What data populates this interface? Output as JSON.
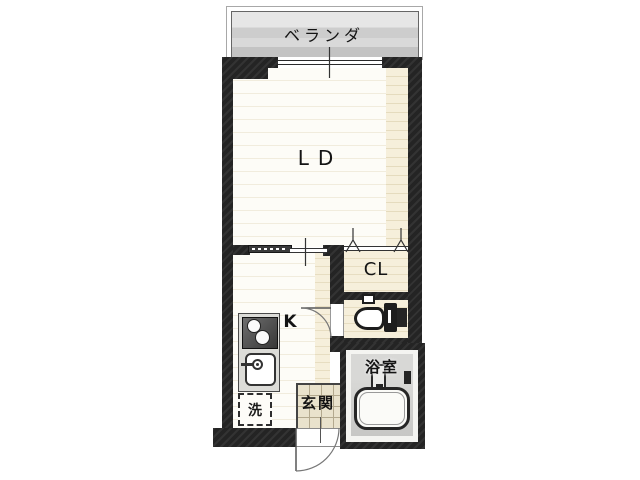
{
  "balcony": {
    "label": "ベランダ"
  },
  "rooms": {
    "living_dining": {
      "label": "LD"
    },
    "closet": {
      "label": "CL"
    },
    "kitchen": {
      "label": "K"
    },
    "bathroom": {
      "label": "浴室"
    },
    "entrance": {
      "label": "玄関"
    },
    "laundry": {
      "label": "洗"
    }
  },
  "fixtures": {
    "window": "sliding-window",
    "entrance_door": "outward-swing-door",
    "toilet_door": "swing-door",
    "closet_door": "folding-door",
    "toilet": "western-toilet",
    "bathtub": "bathtub",
    "stove": "two-burner-stove",
    "sink": "kitchen-sink",
    "washing_machine": "washing-machine-space"
  },
  "colors": {
    "wall": "#242424",
    "balcony_gray": "#d6d6d6",
    "floor_white": "#fdfcf7",
    "floor_beige": "#f6efdb",
    "bath_floor": "#cccccc",
    "entrance_tile": "#e9e2cc"
  }
}
